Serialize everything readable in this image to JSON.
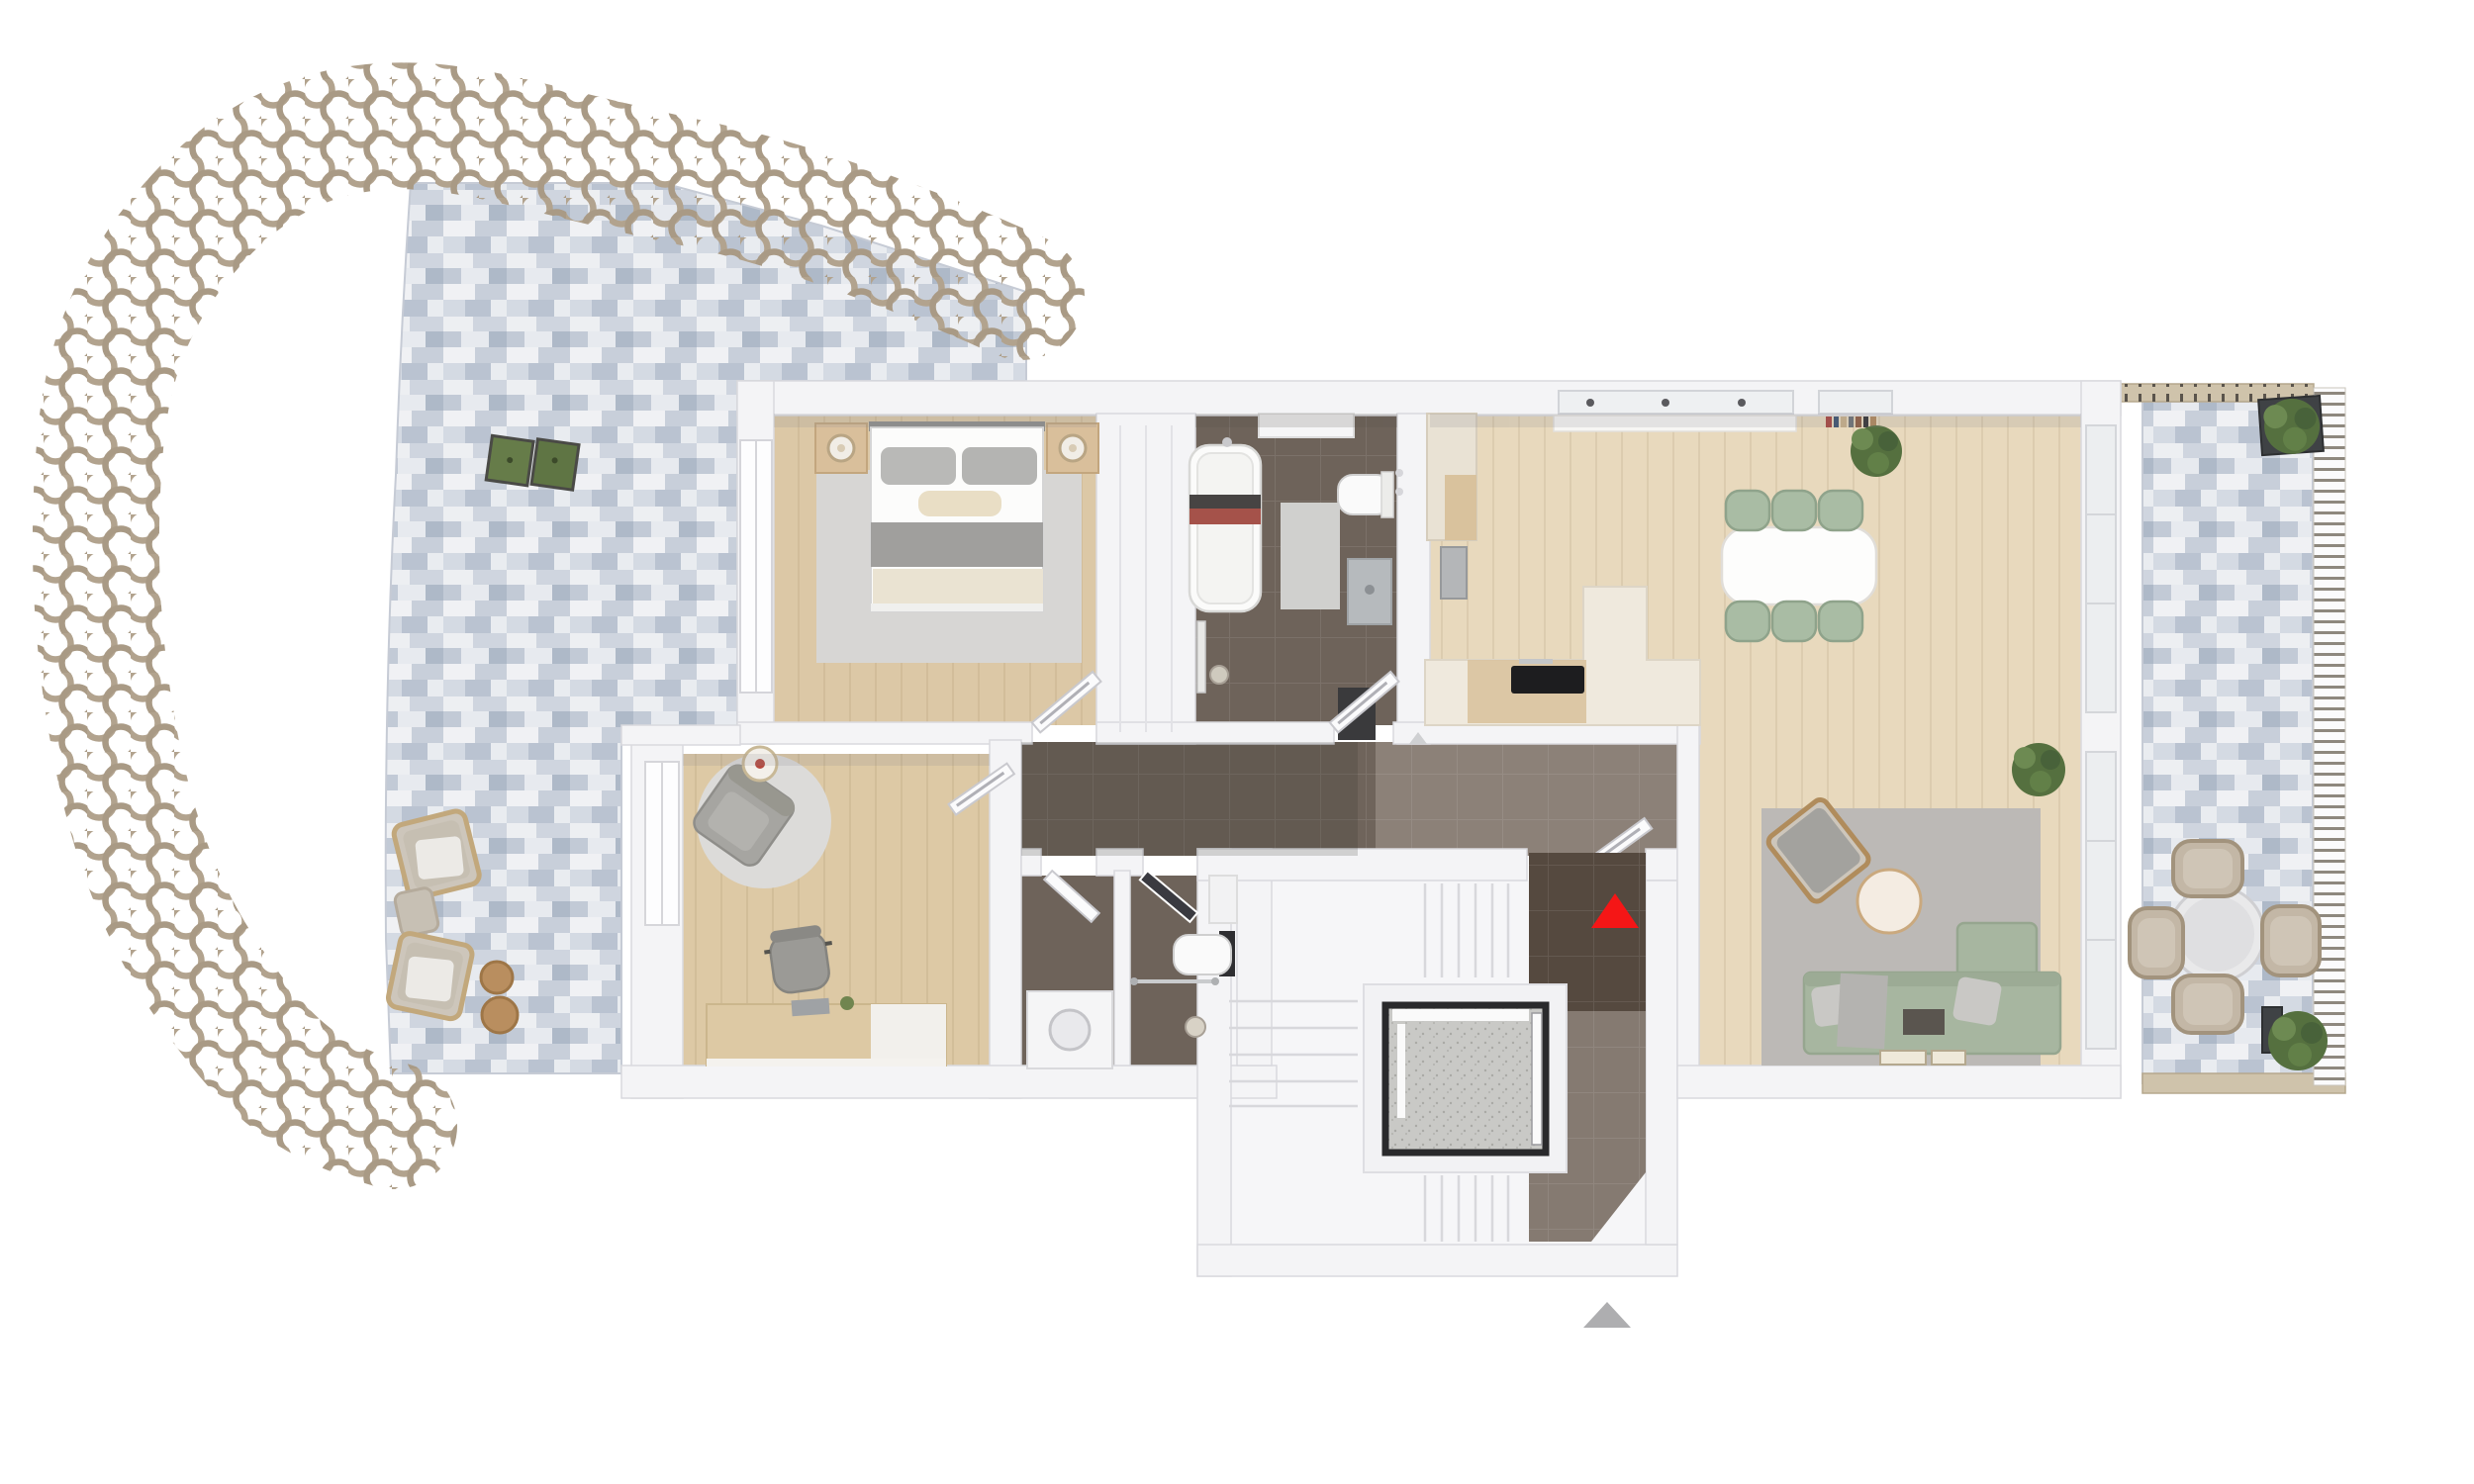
{
  "scene": {
    "type": "3d-floor-plan-top-view",
    "description": "Rendered top-down 3D floor plan of an apartment with two terraces, stairwell and elevator",
    "entrance_marker": {
      "shape": "triangle",
      "direction": "up",
      "color": "#f51616"
    },
    "secondary_marker": {
      "shape": "triangle",
      "direction": "up",
      "color": "#aeaeb0"
    }
  },
  "palette": {
    "wall": "#f4f4f6",
    "wall_edge": "#d9d9de",
    "wood_bedroom": "#dcc8a6",
    "wood_kitchen": "#e8d9bd",
    "wood_office": "#ddc9a5",
    "dark_tile": "#6e635a",
    "landing_tile": "#8d8179",
    "terrace_tile_base": "#dce0e8",
    "ring_screen": "#b2a38e",
    "sofa_green": "#a7b6a0",
    "chair_green": "#a9bca4",
    "rug_gray": "#bcb9b6",
    "outdoor_wood": "#cfc3ab",
    "plant_green": "#5d7a46"
  },
  "rooms": {
    "bedroom": {
      "label": "Bedroom"
    },
    "bathroom": {
      "label": "Bathroom"
    },
    "kitchen": {
      "label": "Kitchen and dining area"
    },
    "living": {
      "label": "Living room"
    },
    "office": {
      "label": "Office / study"
    },
    "hallway": {
      "label": "Hallway"
    },
    "storage": {
      "label": "Storage / utility room"
    },
    "wc": {
      "label": "Guest WC"
    },
    "stairwell": {
      "label": "Stairwell with elevator"
    },
    "terrace_left": {
      "label": "Large terrace with ring screen"
    },
    "terrace_right": {
      "label": "Side terrace"
    }
  },
  "furniture": {
    "bedroom": [
      "double-bed",
      "nightstand-left",
      "nightstand-right",
      "lamp-left",
      "lamp-right",
      "rug",
      "window"
    ],
    "bathroom": [
      "bathtub",
      "towel",
      "toilet",
      "washbasin",
      "bathmat",
      "shower-drain",
      "door"
    ],
    "kitchen": [
      "counter-left",
      "oven",
      "island-l-shape",
      "cooktop",
      "upper-counter",
      "window-band",
      "books",
      "dining-table",
      "six-chairs",
      "corner-plant"
    ],
    "living": [
      "corner-sofa",
      "pillows",
      "throw",
      "coffee-table",
      "armchair",
      "rug",
      "floor-books",
      "plant",
      "windows"
    ],
    "office": [
      "round-rug",
      "lounge-chair",
      "floor-lamp",
      "desk",
      "laptop",
      "office-chair",
      "window",
      "door"
    ],
    "storage": [
      "washing-machine",
      "door"
    ],
    "wc": [
      "toilet",
      "cistern",
      "towel-rail",
      "shelf",
      "floor-drain",
      "door"
    ],
    "stairwell": [
      "stair-flight-top",
      "stair-flight-left",
      "stair-flight-bottom",
      "elevator-cab",
      "entrance-landing",
      "entrance-arrow"
    ],
    "terrace_left": [
      "ring-screen",
      "checkered-tiles",
      "planter-boxes",
      "lounge-chair-1",
      "lounge-chair-2",
      "footstool",
      "side-table-1",
      "side-table-2"
    ],
    "terrace_right": [
      "round-table",
      "four-wicker-chairs",
      "bush-planter-top",
      "bush-planter-bottom",
      "slat-railing",
      "wood-edge-boards"
    ]
  }
}
